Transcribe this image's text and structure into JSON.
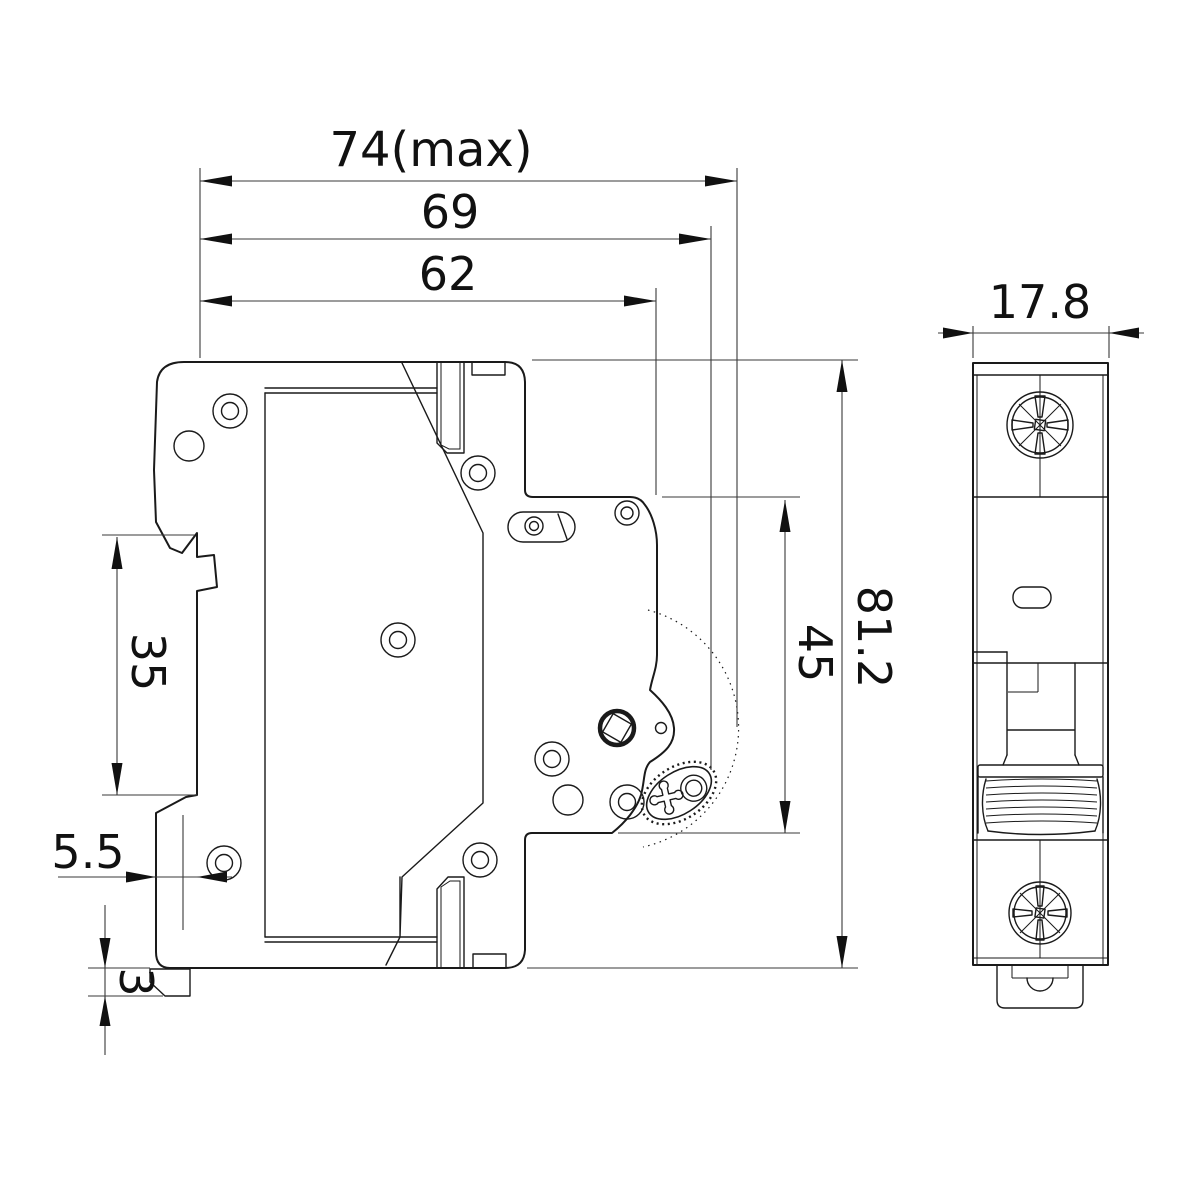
{
  "page": {
    "background": "#ffffff",
    "line_color": "#1a1a1a"
  },
  "drawing": {
    "type": "engineering-dimension-drawing",
    "subject": "DIN-rail miniature circuit breaker - side and front views",
    "dims": {
      "d74": "74(max)",
      "d69": "69",
      "d62": "62",
      "d81": "81.2",
      "d45": "45",
      "d35": "35",
      "d55": "5.5",
      "d3": "3",
      "d178": "17.8"
    }
  }
}
